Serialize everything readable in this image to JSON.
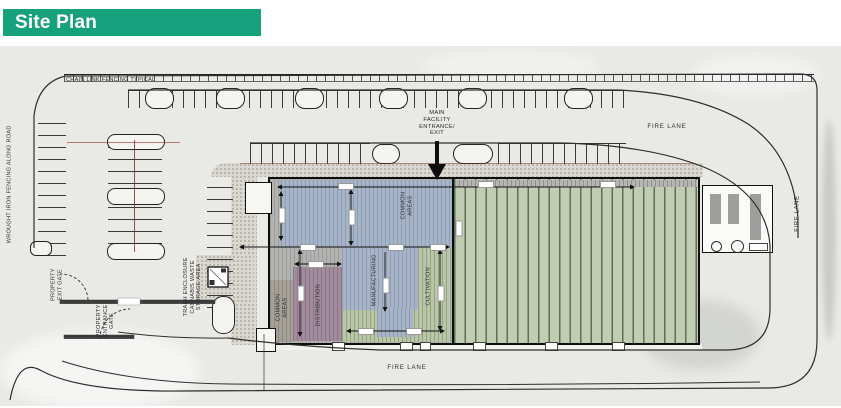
{
  "header": {
    "title": "Site Plan",
    "accent_color": "#16A07C"
  },
  "plan": {
    "fence_top_label": "CHAIN LINK FENCING TYPICAL",
    "fence_left_label": "WROUGHT IRON FENCING ALONG ROAD",
    "main_entrance_label": "MAIN\nFACILITY\nENTRANCE/\nEXIT",
    "fire_lane_top": "FIRE LANE",
    "fire_lane_right": "FIRE LANE",
    "fire_lane_bottom": "FIRE LANE",
    "exit_gate_label": "PROPERTY\nEXIT GATE",
    "entrance_gate_label": "PROPERTY\nENTRANCE\nGATE",
    "trash_label": "TRASH ENCLOSURE\nCANNABIS WASTE\nSTORAGE AREA",
    "zones": {
      "common_top": "COMMON\nAREAS",
      "manufacturing": "MANUFACTURING",
      "cultivation": "CULTIVATION",
      "distribution": "DISTRIBUTION",
      "common_bottom": "COMMON\nAREAS"
    },
    "zone_colors": {
      "common_blue": "#A7B3C6",
      "cultivation_green": "#C1CDB3",
      "distribution_mauve": "#A18B9C",
      "common_gray": "#A5A098",
      "building_gray": "#B3B3B1"
    }
  }
}
